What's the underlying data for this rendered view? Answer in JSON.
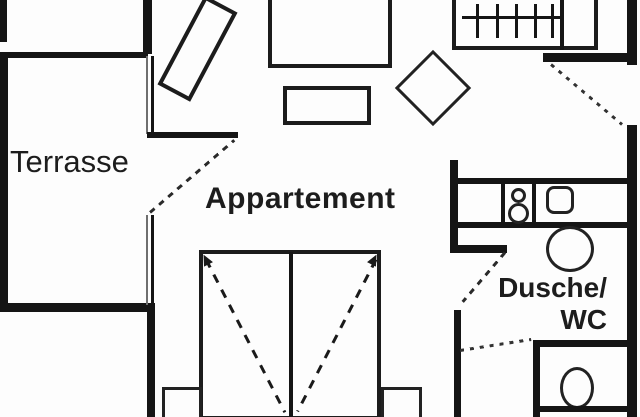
{
  "plan": {
    "type": "apartment-floor-plan",
    "labels": {
      "terrace": "Terrasse",
      "apartment": "Appartement",
      "bathroom_line1": "Dusche/",
      "bathroom_line2": "WC"
    },
    "rooms": [
      "Terrasse",
      "Appartement",
      "Dusche/WC"
    ],
    "furniture_icons": [
      "lounge-chair",
      "sofa-table",
      "coffee-table",
      "square-table",
      "wardrobe-with-hangers",
      "double-bed",
      "nightstand-left",
      "nightstand-right",
      "kitchen-hob",
      "kitchen-sink",
      "washbasin",
      "toilet"
    ],
    "door_swing_lines": [
      "terrace-door",
      "entrance-door",
      "bathroom-door",
      "wc-door"
    ],
    "colors": {
      "background": "#fdfdfd",
      "wall": "#151515",
      "furniture_stroke": "#222222",
      "window_grey": "#6f6f6f",
      "text": "#1d1d1d"
    }
  }
}
